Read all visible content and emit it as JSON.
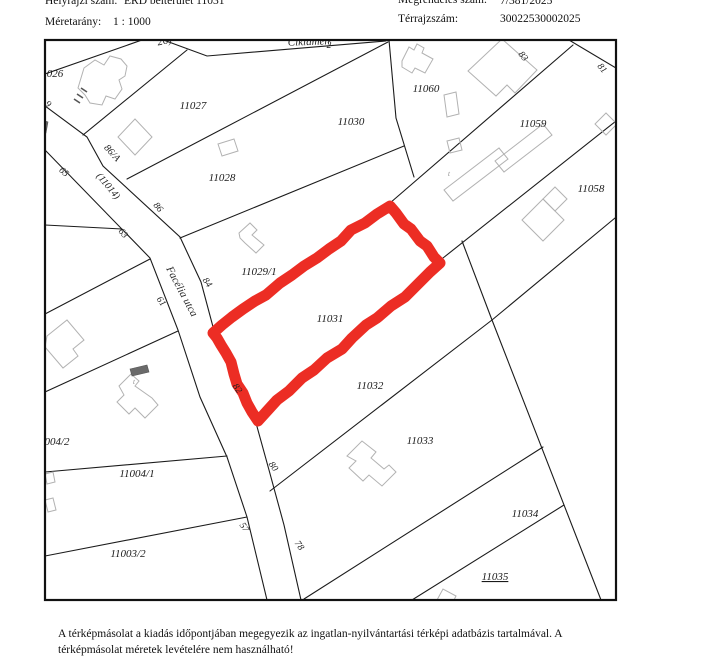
{
  "header": {
    "hrsz_label": "Helyrajzi szám:",
    "hrsz_value": "ÉRD belterület 11031",
    "scale_label": "Méretarány:",
    "scale_value": "1 : 1000",
    "order_label": "Megrendelés szám:",
    "order_value": "7/381/2025",
    "sheet_label": "Térrajzszám:",
    "sheet_value": "30022530002025"
  },
  "footer": {
    "line1": "A térképmásolat a kiadás időpontjában megegyezik az ingatlan-nyilvántartási térképi adatbázis tartalmával. A",
    "line2": "térképmásolat méretek levételére nem használható!"
  },
  "map": {
    "highlighted_parcel": "11031",
    "highlight_color": "#ec2d24",
    "line_color": "#1b1b1b",
    "building_color": "#b2b2b2",
    "labels": [
      {
        "text": "026",
        "x": 55,
        "y": 77,
        "rot": 0,
        "cls": "p"
      },
      {
        "text": "11027",
        "x": 193,
        "y": 109,
        "rot": 0,
        "cls": "p"
      },
      {
        "text": "11028",
        "x": 222,
        "y": 181,
        "rot": 0,
        "cls": "p"
      },
      {
        "text": "11029/1",
        "x": 259,
        "y": 275,
        "rot": 0,
        "cls": "p"
      },
      {
        "text": "11030",
        "x": 351,
        "y": 125,
        "rot": 0,
        "cls": "p"
      },
      {
        "text": "11060",
        "x": 426,
        "y": 92,
        "rot": 0,
        "cls": "p"
      },
      {
        "text": "11059",
        "x": 533,
        "y": 127,
        "rot": 0,
        "cls": "p"
      },
      {
        "text": "11058",
        "x": 591,
        "y": 192,
        "rot": 0,
        "cls": "p"
      },
      {
        "text": "11031",
        "x": 330,
        "y": 322,
        "rot": 0,
        "cls": "p"
      },
      {
        "text": "11032",
        "x": 370,
        "y": 389,
        "rot": 0,
        "cls": "p"
      },
      {
        "text": "11033",
        "x": 420,
        "y": 444,
        "rot": 0,
        "cls": "p"
      },
      {
        "text": "11034",
        "x": 525,
        "y": 517,
        "rot": 0,
        "cls": "p"
      },
      {
        "text": "11035",
        "x": 495,
        "y": 580,
        "rot": 0,
        "cls": "p",
        "u": 1
      },
      {
        "text": "11004/1",
        "x": 137,
        "y": 477,
        "rot": 0,
        "cls": "p"
      },
      {
        "text": "11003/2",
        "x": 128,
        "y": 557,
        "rot": 0,
        "cls": "p"
      },
      {
        "text": "004/2",
        "x": 57,
        "y": 445,
        "rot": 0,
        "cls": "p"
      },
      {
        "text": "2",
        "x": 329,
        "y": 48,
        "rot": 0,
        "cls": "h"
      },
      {
        "text": "83",
        "x": 521,
        "y": 58,
        "rot": 50,
        "cls": "h"
      },
      {
        "text": "81",
        "x": 600,
        "y": 70,
        "rot": 50,
        "cls": "h"
      },
      {
        "text": "86",
        "x": 156,
        "y": 209,
        "rot": 50,
        "cls": "h"
      },
      {
        "text": "84",
        "x": 205,
        "y": 284,
        "rot": 55,
        "cls": "h"
      },
      {
        "text": "82",
        "x": 235,
        "y": 390,
        "rot": 55,
        "cls": "h"
      },
      {
        "text": "80",
        "x": 271,
        "y": 468,
        "rot": 55,
        "cls": "h"
      },
      {
        "text": "78",
        "x": 297,
        "y": 547,
        "rot": 55,
        "cls": "h"
      },
      {
        "text": "57",
        "x": 242,
        "y": 529,
        "rot": 55,
        "cls": "h"
      },
      {
        "text": "65",
        "x": 62,
        "y": 174,
        "rot": 42,
        "cls": "h"
      },
      {
        "text": "63",
        "x": 121,
        "y": 235,
        "rot": 50,
        "cls": "h"
      },
      {
        "text": "61",
        "x": 159,
        "y": 303,
        "rot": 55,
        "cls": "h"
      },
      {
        "text": "9",
        "x": 46,
        "y": 106,
        "rot": 45,
        "cls": "h"
      },
      {
        "text": "86/A",
        "x": 110,
        "y": 155,
        "rot": 48,
        "cls": "r"
      },
      {
        "text": "(11014)",
        "x": 106,
        "y": 188,
        "rot": 50,
        "cls": "r"
      },
      {
        "text": "Ciklámen",
        "x": 309,
        "y": 45,
        "rot": -2,
        "cls": "s"
      },
      {
        "text": "26)",
        "x": 165,
        "y": 44,
        "rot": -12,
        "cls": "s"
      },
      {
        "text": "Facélia utca",
        "x": 179,
        "y": 293,
        "rot": 62,
        "cls": "s"
      },
      {
        "text": "t",
        "x": 449,
        "y": 176,
        "rot": 0,
        "cls": "y"
      },
      {
        "text": "t",
        "x": 134,
        "y": 384,
        "rot": 0,
        "cls": "y"
      }
    ]
  }
}
